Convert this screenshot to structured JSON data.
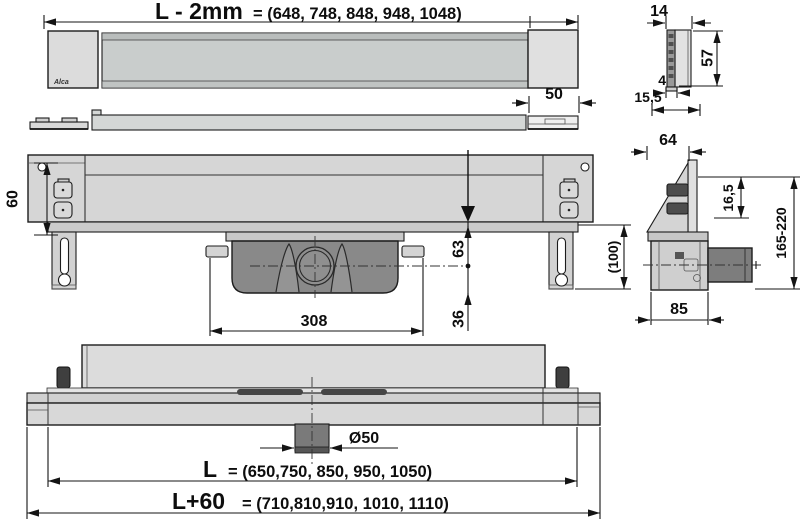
{
  "meta": {
    "brand_logo": "Alca",
    "drawing_type": "shower-drain-channel-technical-views"
  },
  "colors": {
    "background": "#ffffff",
    "line": "#1c1c1c",
    "fill_light": "#dcdcdc",
    "fill_mid": "#c9cdcc",
    "fill_body": "#d6d6d6",
    "fill_trap": "#898989",
    "fill_pipe": "#7d7d7d",
    "fill_pin": "#3f3f3f",
    "fill_clip_dark": "#4d4d4d"
  },
  "dims": {
    "top_length_label": "L - 2mm",
    "top_length_values": "= (648, 748, 848, 948, 1048)",
    "strip_width": "50",
    "end_width": "14",
    "end_height": "57",
    "end_thickness": "4",
    "end_depth": "15,5",
    "front_height": "60",
    "front_outlet_center": "63",
    "front_outlet_below": "36",
    "front_trap_width": "308",
    "front_leg_height": "(100)",
    "side_top_width": "64",
    "side_offset": "16,5",
    "side_height_range": "165-220",
    "side_depth": "85",
    "bottom_outlet_diameter": "Ø50",
    "bottom_len_label": "L",
    "bottom_len_values": "= (650,750, 850, 950, 1050)",
    "bottom_total_label": "L+60",
    "bottom_total_values": "= (710,810,910, 1010, 1110)"
  }
}
